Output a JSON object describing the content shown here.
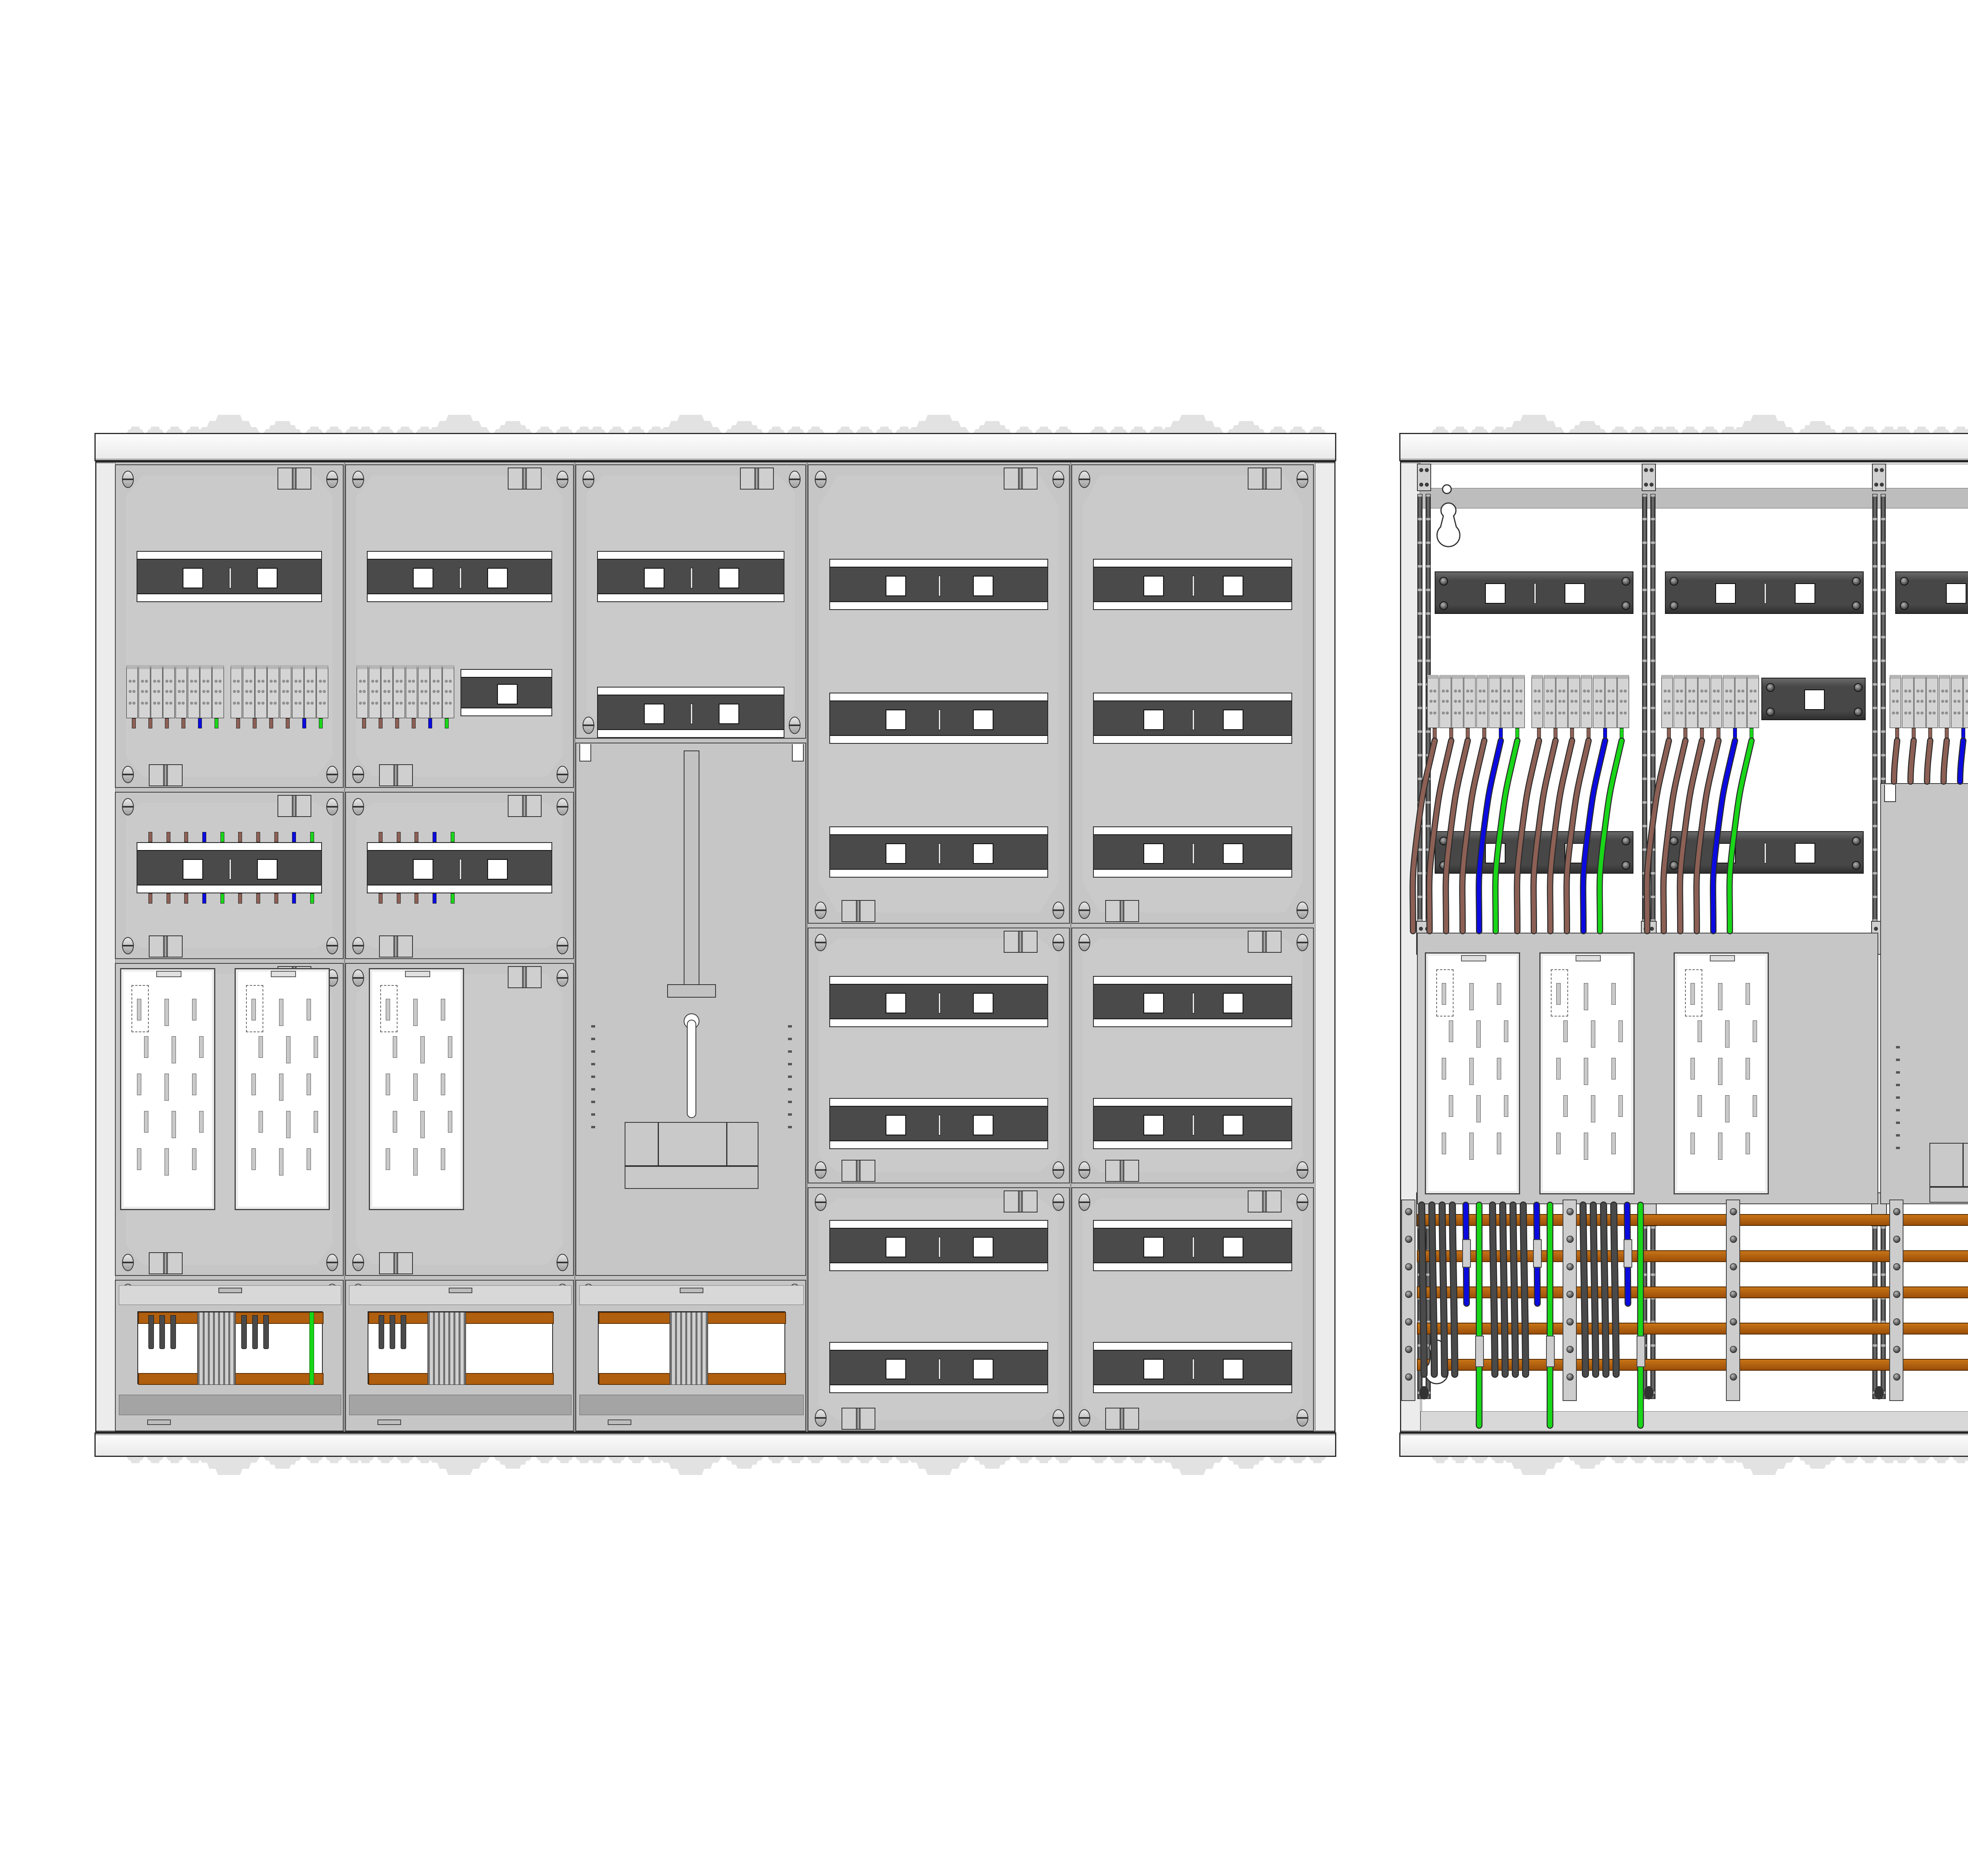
{
  "colors": {
    "background": "#ffffff",
    "panel": "#c3c3c3",
    "panel_light": "#d8d8d8",
    "panel_band": "#a4a4a4",
    "rail_dark": "#4a4a4a",
    "outline": "#2b2b2b",
    "busbar_copper": "#b05f0f",
    "wire_brown": "#8d6055",
    "wire_blue": "#0b0be0",
    "wire_green": "#19d619",
    "wire_phase": "#4a4a4a",
    "terminal_body": "#d4d4d4",
    "neutral_rail": "#1a1ae0",
    "pe_rail": "#22cc22",
    "interior": "#ffffff",
    "support": "#cdcdcd"
  },
  "covered_view": {
    "columns": 5,
    "cover_rail_rows": 16,
    "terminal_groups": 3,
    "terminal_blocks_per_group": 8,
    "stub_colors": [
      "brown",
      "brown",
      "brown",
      "brown",
      "blue",
      "green"
    ],
    "wired_cover_stub_cycle": [
      "brown",
      "brown",
      "brown",
      "blue",
      "green"
    ],
    "meter_plates": 3,
    "busbar_cover_windows": 3,
    "main_switch_panels": 1
  },
  "internal_view": {
    "din_rails": 13,
    "terminal_groups": 4,
    "terminal_blocks_per_group": 8,
    "bundle_colors": [
      "brown",
      "brown",
      "brown",
      "brown",
      "blue",
      "green"
    ],
    "drop_colors": [
      "phase",
      "phase",
      "phase",
      "phase",
      "blue",
      "green"
    ],
    "busbars": 5,
    "busbar_supports": 5,
    "meter_plates": 3,
    "neutral_rails": 2,
    "pe_rails": 2,
    "terminal_rail_labels": [
      "N 1 2 3 4 5 6 7 8 9 10 11 12 13",
      "N 1 2 3 4 5 6 7 8 9 10 11 12 13",
      "27 28 29 30 31 32 33"
    ],
    "keyholes": 4,
    "main_switch_panels": 1
  }
}
